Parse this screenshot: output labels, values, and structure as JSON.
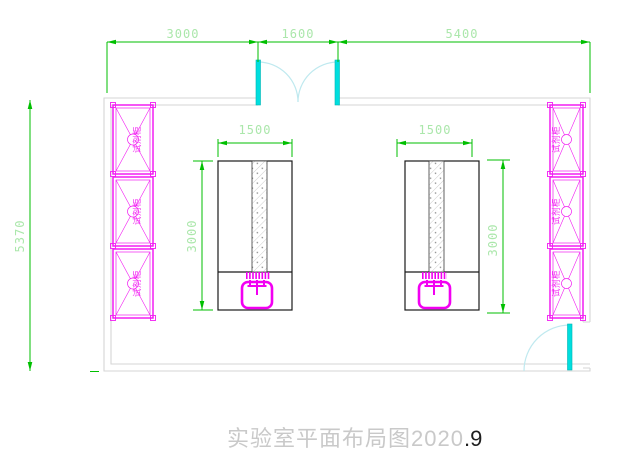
{
  "title": {
    "main": "实验室平面布局图2020",
    "accent": ".9"
  },
  "dims": {
    "top": [
      "3000",
      "1600",
      "5400"
    ],
    "overall": "5370",
    "benchLeft": {
      "width": "1500",
      "depth": "3000"
    },
    "benchRight": {
      "width": "1500",
      "depth": "3000"
    }
  },
  "cabinets": {
    "left": [
      "试剂柜",
      "试剂柜",
      "试剂柜"
    ],
    "right": [
      "试剂柜",
      "试剂柜",
      "试剂柜"
    ]
  },
  "colors": {
    "dimension_line": "#00bf00",
    "dimension_text": "#abe7ab",
    "wall": "#d6d6d6",
    "cabinet": "#f21df2",
    "sink": "#f200f2",
    "door_leaf": "#00dede",
    "door_swing": "#bfe9ef",
    "bench_outline": "#1a1a1a",
    "title_main": "#c9c9c9",
    "title_accent": "#1e1e1e"
  }
}
